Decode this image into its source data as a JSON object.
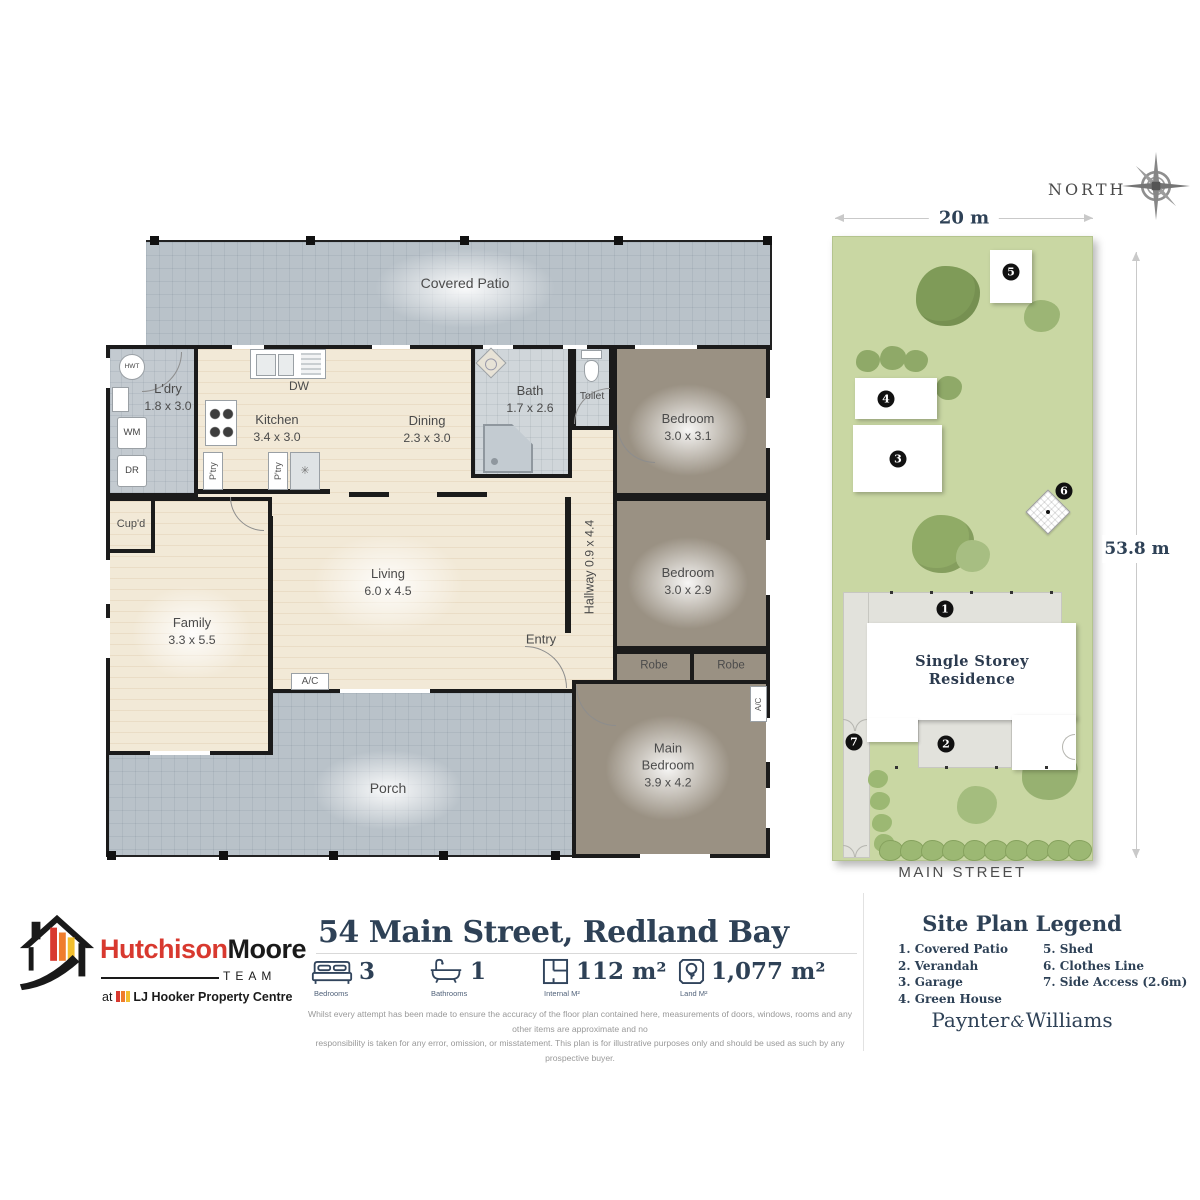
{
  "floorplan": {
    "rooms": {
      "covered_patio": {
        "name": "Covered Patio"
      },
      "ldry": {
        "name": "L'dry",
        "dims": "1.8 x 3.0"
      },
      "kitchen": {
        "name": "Kitchen",
        "dims": "3.4 x 3.0"
      },
      "dining": {
        "name": "Dining",
        "dims": "2.3 x 3.0"
      },
      "bath": {
        "name": "Bath",
        "dims": "1.7 x 2.6"
      },
      "toilet": {
        "name": "Toilet"
      },
      "bedroom1": {
        "name": "Bedroom",
        "dims": "3.0 x 3.1"
      },
      "bedroom2": {
        "name": "Bedroom",
        "dims": "3.0 x 2.9"
      },
      "hallway": {
        "name": "Hallway",
        "dims": "0.9 x 4.4"
      },
      "living": {
        "name": "Living",
        "dims": "6.0 x 4.5"
      },
      "family": {
        "name": "Family",
        "dims": "3.3 x 5.5"
      },
      "entry": {
        "name": "Entry"
      },
      "cupd": {
        "name": "Cup'd"
      },
      "main_bedroom": {
        "line1": "Main",
        "line2": "Bedroom",
        "dims": "3.9 x 4.2"
      },
      "porch": {
        "name": "Porch"
      },
      "robe": {
        "name": "Robe"
      }
    },
    "fixtures": {
      "hwt": "HWT",
      "wm": "WM",
      "dr": "DR",
      "dw": "DW",
      "ptry": "P'try",
      "ac": "A/C"
    }
  },
  "siteplan": {
    "north_label": "NORTH",
    "width_dim": "20 m",
    "depth_dim": "53.8 m",
    "street": "MAIN STREET",
    "residence_line1": "Single Storey",
    "residence_line2": "Residence",
    "badges": [
      "1",
      "2",
      "3",
      "4",
      "5",
      "6",
      "7"
    ]
  },
  "footer": {
    "brand": {
      "name_red": "Hutchison",
      "name_black": "Moore",
      "team": "TEAM",
      "tagline_at": "at",
      "tagline": "LJ Hooker Property Centre"
    },
    "title": "54 Main Street, Redland Bay",
    "stats": [
      {
        "value": "3",
        "label": "Bedrooms"
      },
      {
        "value": "1",
        "label": "Bathrooms"
      },
      {
        "value": "112 m²",
        "label": "Internal M²"
      },
      {
        "value": "1,077 m²",
        "label": "Land M²"
      }
    ],
    "disclaimer_line1": "Whilst every attempt has been made to ensure the accuracy of the floor plan contained here, measurements of doors, windows, rooms and any other items are approximate and no",
    "disclaimer_line2": "responsibility is taken for any error, omission, or misstatement. This plan is for illustrative purposes only and should be used as such by any prospective buyer.",
    "legend": {
      "heading": "Site Plan Legend",
      "items": [
        "1. Covered Patio",
        "2. Verandah",
        "3. Garage",
        "4. Green House",
        "5. Shed",
        "6. Clothes Line",
        "7. Side Access (2.6m)"
      ]
    },
    "brand2": {
      "first": "Paynter",
      "amp": "&",
      "last": "Williams"
    }
  },
  "colors": {
    "navy": "#2e4156",
    "brand_red": "#d8392f",
    "brand_orange": "#ef7d2d",
    "brand_yellow": "#f2bf2f",
    "grass": "#c9d7a3",
    "patio_tile": "#b9c2c9",
    "bedroom_taupe": "#9a9183",
    "floor_cream": "#f2e9d7"
  }
}
